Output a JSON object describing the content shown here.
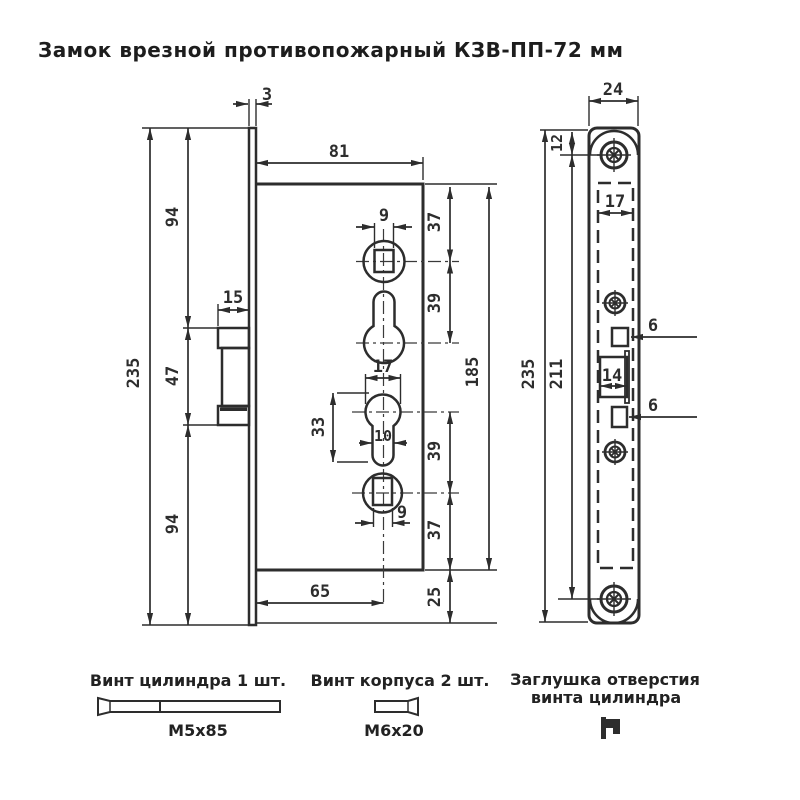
{
  "title": "Замок врезной противопожарный КЗВ-ПП-72 мм",
  "colors": {
    "line": "#2d2d2d",
    "background": "#ffffff"
  },
  "front_view": {
    "dims": {
      "faceplate_thickness": "3",
      "body_width": "81",
      "top_to_latch": "94",
      "latch_height": "47",
      "latch_to_bottom": "94",
      "overall_height": "235",
      "latch_protrusion": "15",
      "top_square": "9",
      "edge_to_square": "37",
      "square_to_keyhole": "39",
      "keyhole_dia": "17",
      "keyhole_length": "33",
      "keyhole_stem": "10",
      "keyhole_to_square_lower": "39",
      "bottom_square": "9",
      "square_to_bottom": "37",
      "body_height": "185",
      "backset": "65",
      "bottom_offset": "25"
    }
  },
  "face_view": {
    "dims": {
      "plate_width": "24",
      "top_to_first_hole": "12",
      "body_width": "17",
      "overall_height": "235",
      "holes_span": "211",
      "latch_offset_top": "6",
      "deadbolt_width": "14",
      "latch_offset_bottom": "6"
    }
  },
  "parts": {
    "cylinder_screw": {
      "label": "Винт цилиндра 1 шт.",
      "size": "M5x85"
    },
    "body_screw": {
      "label": "Винт корпуса 2 шт.",
      "size": "M6x20"
    },
    "plug": {
      "label_line1": "Заглушка отверстия",
      "label_line2": "винта цилиндра"
    }
  }
}
